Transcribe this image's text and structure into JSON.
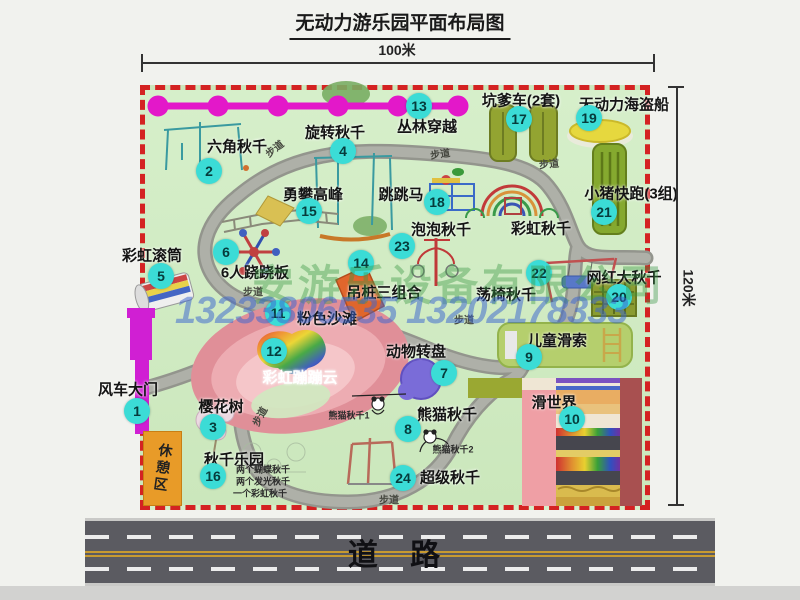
{
  "title": "无动力游乐园平面布局图",
  "dimensions": {
    "width_label": "100米",
    "height_label": "120米"
  },
  "watermark": {
    "company": "安游乐设备有限公司",
    "phones": "13233806535 13202178333"
  },
  "road": {
    "label": "道  路"
  },
  "colors": {
    "badge_bg": "#3bdcd6",
    "map_bg": "#d2ecc6",
    "border_red": "#d42222",
    "chain_magenta": "#e318c9",
    "gate_magenta": "#d01fd3",
    "rest_area_orange": "#e89b28",
    "road_gray": "#5b5b61"
  },
  "map": {
    "rest_area_label": "休憩区",
    "attractions": [
      {
        "num": 1,
        "name": "风车大门",
        "label_x": 128,
        "label_y": 389,
        "num_x": 137,
        "num_y": 411
      },
      {
        "num": 2,
        "name": "六角秋千",
        "label_x": 237,
        "label_y": 146,
        "num_x": 209,
        "num_y": 171
      },
      {
        "num": 3,
        "name": "樱花树",
        "label_x": 221,
        "label_y": 406,
        "num_x": 213,
        "num_y": 427
      },
      {
        "num": 4,
        "name": "旋转秋千",
        "label_x": 335,
        "label_y": 132,
        "num_x": 343,
        "num_y": 151
      },
      {
        "num": 5,
        "name": "彩虹滚筒",
        "label_x": 152,
        "label_y": 255,
        "num_x": 161,
        "num_y": 276
      },
      {
        "num": 6,
        "name": "6人跷跷板",
        "label_x": 255,
        "label_y": 272,
        "num_x": 226,
        "num_y": 252
      },
      {
        "num": 7,
        "name": "动物转盘",
        "label_x": 416,
        "label_y": 351,
        "num_x": 444,
        "num_y": 373
      },
      {
        "num": 8,
        "name": "熊猫秋千",
        "label_x": 447,
        "label_y": 414,
        "num_x": 408,
        "num_y": 429
      },
      {
        "num": 9,
        "name": "儿童滑索",
        "label_x": 557,
        "label_y": 340,
        "num_x": 529,
        "num_y": 357
      },
      {
        "num": 10,
        "name": "滑世界",
        "label_x": 554,
        "label_y": 402,
        "num_x": 572,
        "num_y": 419
      },
      {
        "num": 11,
        "name": "粉色沙滩",
        "label_x": 327,
        "label_y": 318,
        "num_x": 278,
        "num_y": 313
      },
      {
        "num": 12,
        "name": "彩虹蹦蹦云",
        "label_x": 300,
        "label_y": 377,
        "num_x": 274,
        "num_y": 351,
        "color": "#ffffff"
      },
      {
        "num": 13,
        "name": "丛林穿越",
        "label_x": 427,
        "label_y": 126,
        "num_x": 419,
        "num_y": 106
      },
      {
        "num": 14,
        "name": "吊桩三组合",
        "label_x": 384,
        "label_y": 292,
        "num_x": 361,
        "num_y": 263
      },
      {
        "num": 15,
        "name": "勇攀高峰",
        "label_x": 313,
        "label_y": 194,
        "num_x": 309,
        "num_y": 211
      },
      {
        "num": 16,
        "name": "秋千乐园",
        "label_x": 234,
        "label_y": 459,
        "num_x": 213,
        "num_y": 476
      },
      {
        "num": 17,
        "name": "坑爹车(2套)",
        "label_x": 521,
        "label_y": 100,
        "num_x": 519,
        "num_y": 119
      },
      {
        "num": 18,
        "name": "跳跳马",
        "label_x": 401,
        "label_y": 194,
        "num_x": 437,
        "num_y": 202
      },
      {
        "num": 19,
        "name": "无动力海盗船",
        "label_x": 624,
        "label_y": 104,
        "num_x": 589,
        "num_y": 118
      },
      {
        "num": 20,
        "name": "网红大秋千",
        "label_x": 624,
        "label_y": 277,
        "num_x": 619,
        "num_y": 297
      },
      {
        "num": 21,
        "name": "小猪快跑(3组)",
        "label_x": 631,
        "label_y": 193,
        "num_x": 604,
        "num_y": 212
      },
      {
        "num": 22,
        "name": "荡椅秋千",
        "label_x": 506,
        "label_y": 294,
        "num_x": 539,
        "num_y": 273
      },
      {
        "num": 23,
        "name": "泡泡秋千",
        "label_x": 441,
        "label_y": 229,
        "num_x": 402,
        "num_y": 246
      },
      {
        "num": 24,
        "name": "超级秋千",
        "label_x": 450,
        "label_y": 477,
        "num_x": 403,
        "num_y": 478
      },
      {
        "num": null,
        "name": "彩虹秋千",
        "label_x": 541,
        "label_y": 228
      }
    ],
    "notes": [
      {
        "text": "熊猫秋千1",
        "x": 349,
        "y": 415
      },
      {
        "text": "熊猫秋千2",
        "x": 453,
        "y": 449
      },
      {
        "text": "两个蝴蝶秋千",
        "x": 263,
        "y": 469
      },
      {
        "text": "两个发光秋千",
        "x": 263,
        "y": 481
      },
      {
        "text": "一个彩虹秋千",
        "x": 260,
        "y": 493
      }
    ],
    "path_labels": [
      {
        "text": "步道",
        "x": 274,
        "y": 148,
        "rot": -38
      },
      {
        "text": "步道",
        "x": 440,
        "y": 153,
        "rot": -8
      },
      {
        "text": "步道",
        "x": 549,
        "y": 163,
        "rot": -5
      },
      {
        "text": "步道",
        "x": 253,
        "y": 291,
        "rot": 0
      },
      {
        "text": "步道",
        "x": 464,
        "y": 319,
        "rot": 0
      },
      {
        "text": "步道",
        "x": 259,
        "y": 416,
        "rot": -62
      },
      {
        "text": "步道",
        "x": 389,
        "y": 499,
        "rot": 0
      }
    ]
  }
}
